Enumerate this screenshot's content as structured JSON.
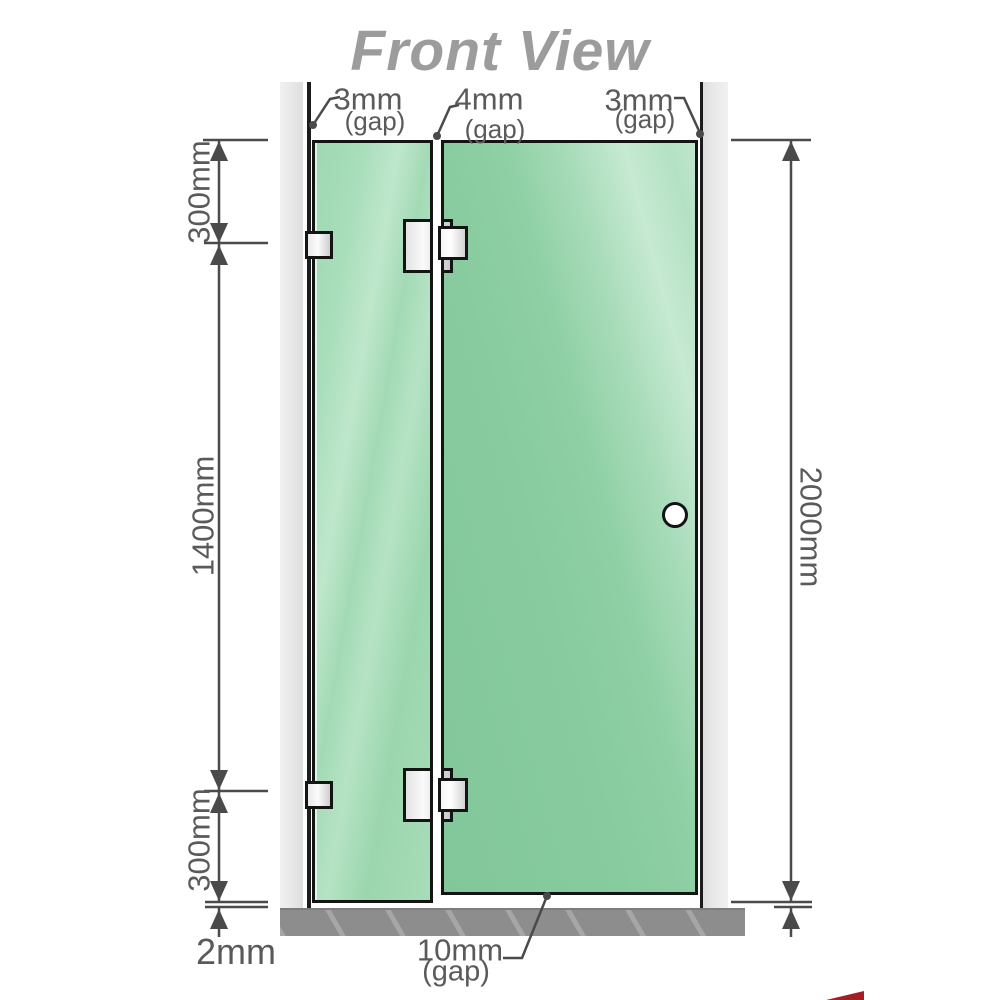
{
  "title": "Front View",
  "gaps": {
    "top_left": {
      "value": "3mm",
      "label": "(gap)"
    },
    "top_middle": {
      "value": "4mm",
      "label": "(gap)"
    },
    "top_right": {
      "value": "3mm",
      "label": "(gap)"
    },
    "bottom": {
      "value": "10mm",
      "label": "(gap)"
    }
  },
  "dimensions": {
    "left_top": "300mm",
    "left_middle": "1400mm",
    "left_bottom": "300mm",
    "floor_clearance": "2mm",
    "right_height": "2000mm"
  },
  "colors": {
    "glass_green_fixed": "#a7dcb8",
    "glass_green_door": "#87cb9e",
    "glass_highlight": "#c6ead2",
    "wall_channel_gray": "#e8e8e8",
    "base_gray": "#8d8d8d",
    "outline_black": "#141414",
    "dimension_gray": "#4a4a4a",
    "label_text_gray": "#5a5a5a",
    "title_gray": "#9c9c9c",
    "corner_red": "#a31f24"
  }
}
